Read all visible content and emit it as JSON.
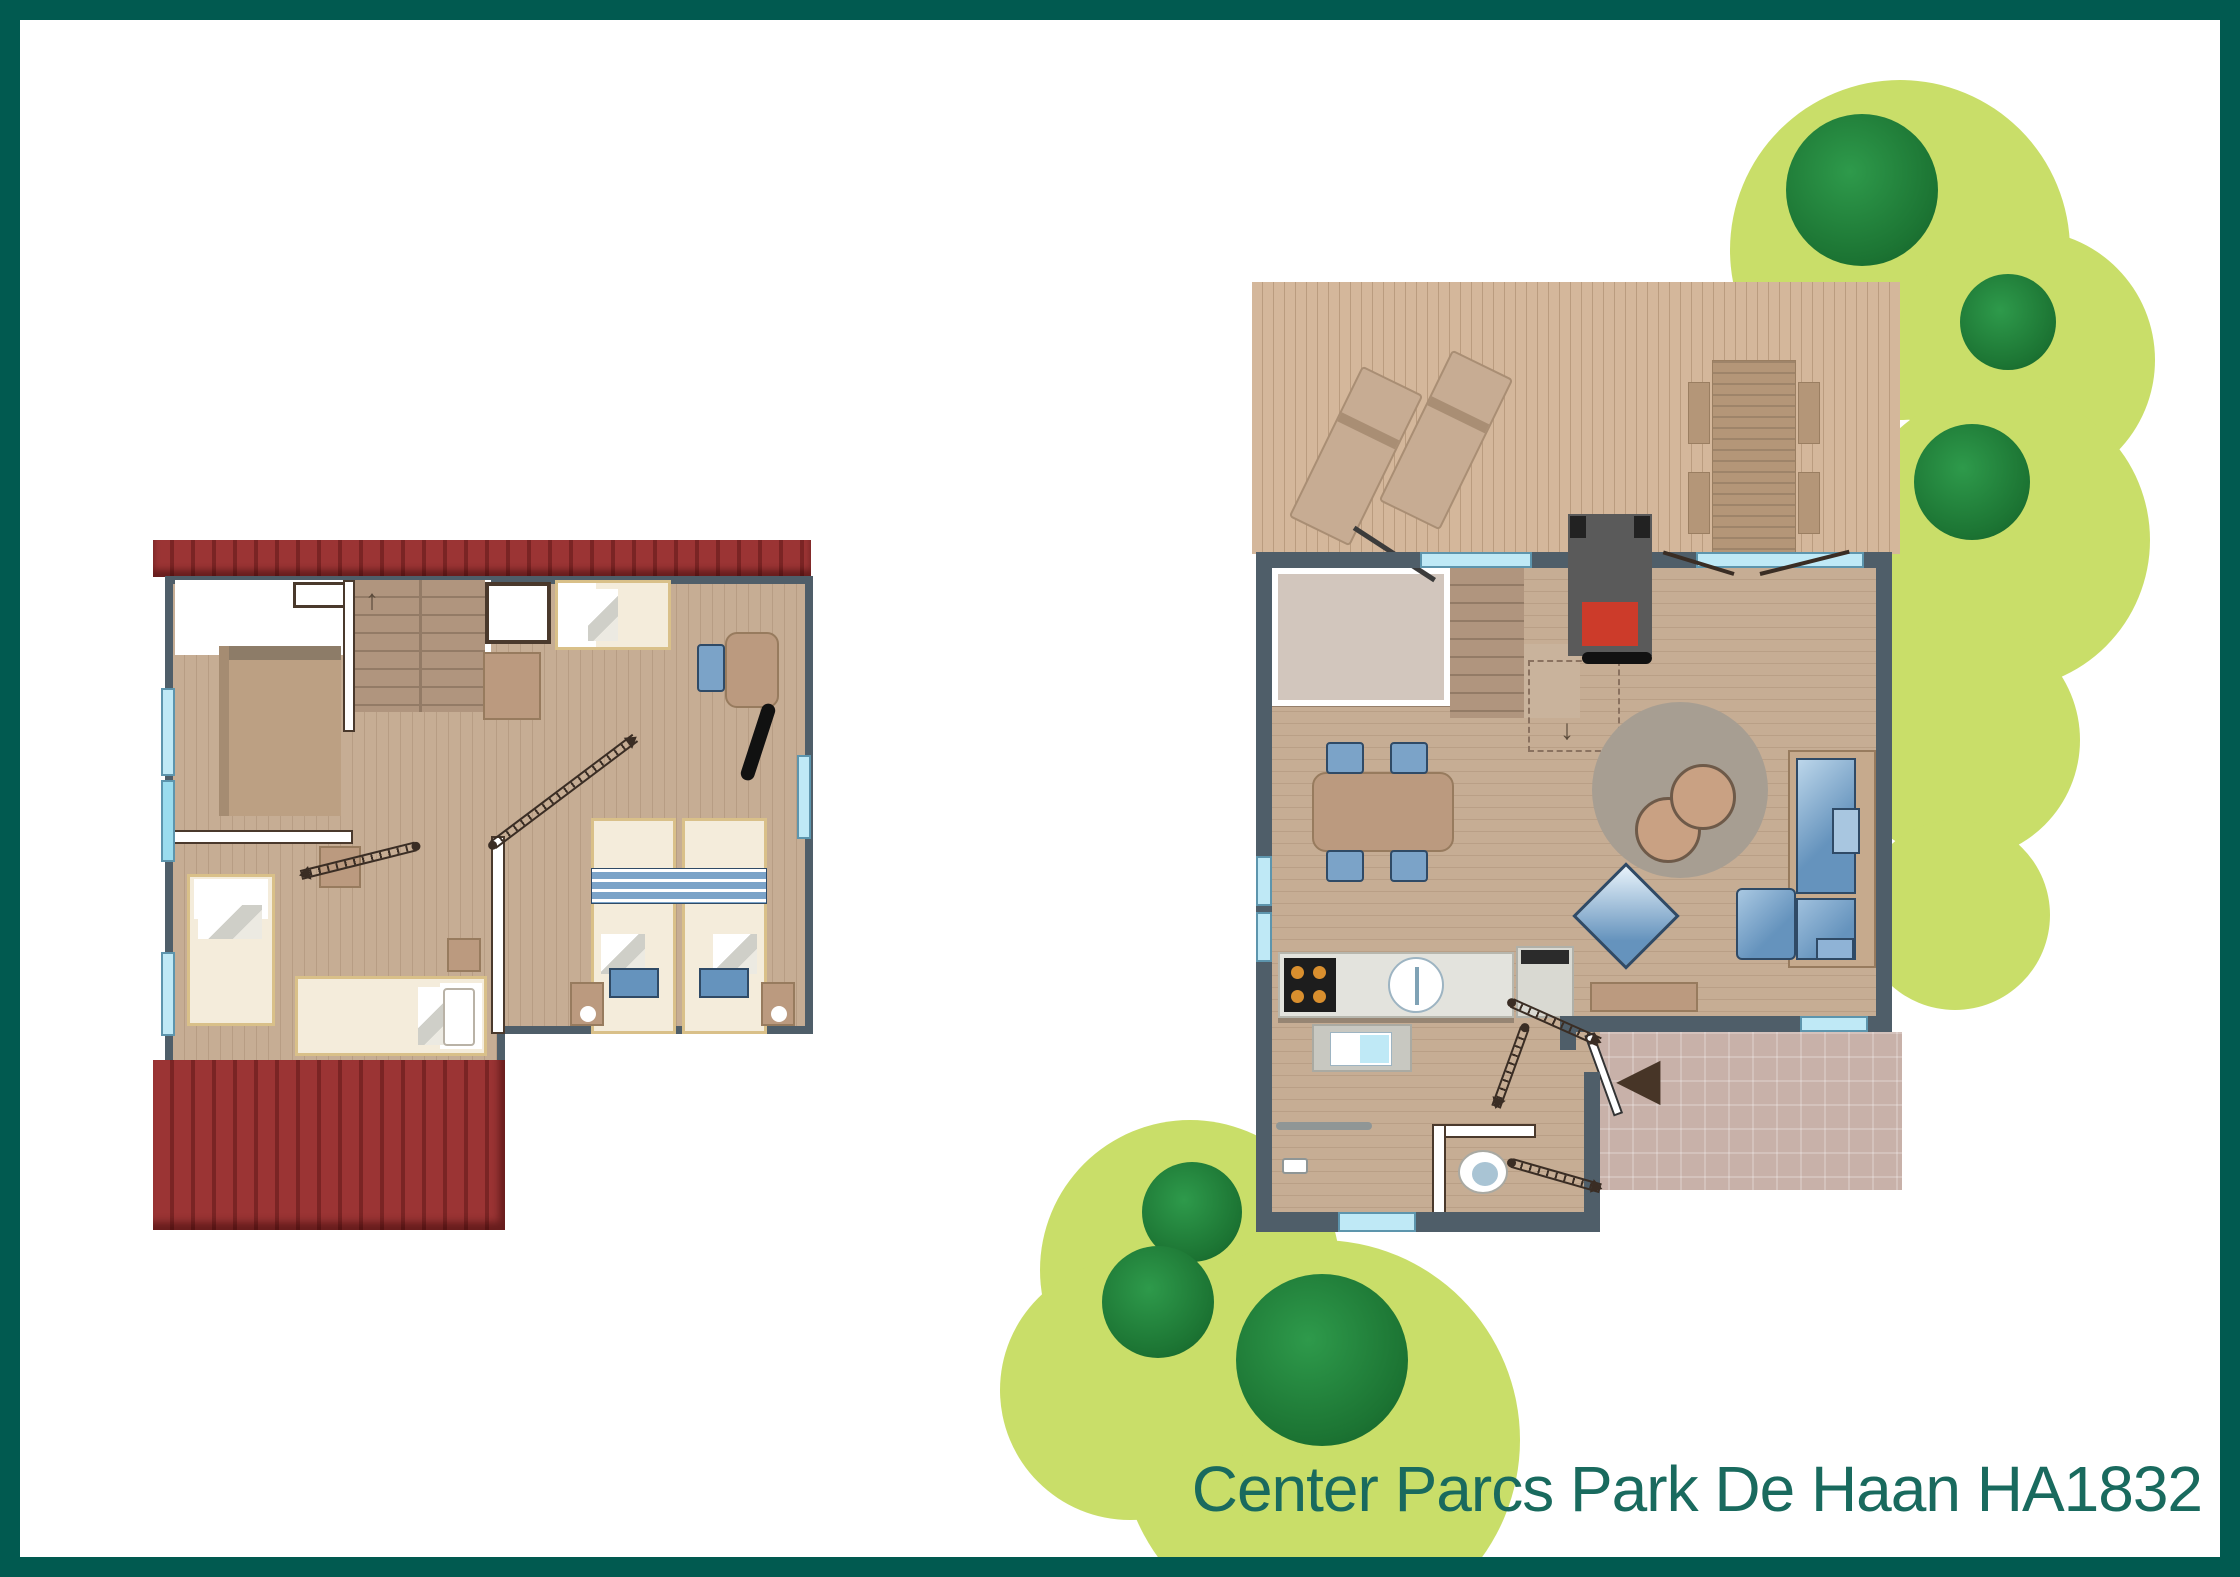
{
  "title": {
    "label": "Center Parcs Park De Haan HA1832"
  },
  "icons": {
    "entrance-arrow": "◀",
    "stairs-up-arrow": "↑",
    "stairs-down-arrow": "↓"
  },
  "colors": {
    "frame": "#015a50",
    "title": "#196a5e",
    "wall": "#4f5e69",
    "wwall-border": "#4a392c",
    "white-wall": "#ffffff",
    "floor": "#c6ad94",
    "room-pink": "#d2c6bd",
    "stairs": "#b0957e",
    "stair-line": "#937b66",
    "roof": "#9b3434",
    "roof-dark": "#7a2424",
    "deck": "#d4b79b",
    "green-light": "#c9de69",
    "tree-dark": "#1c7433",
    "window": "#bfe9f6",
    "window-frame": "#5d95ad",
    "bed": "#f4ecdb",
    "bed-frame": "#d9c089",
    "tan": "#bb9a7f",
    "tan-dark": "#977b5e",
    "blue": "#6593bd",
    "blue-light": "#a8c6e0",
    "blue-border": "#2f4a66",
    "chair-blue": "#7ba3c8",
    "rug": "#a79e92",
    "pouf": "#c9a183",
    "pouf-border": "#6e5a49",
    "patio": "#c8b1a9",
    "counter": "#e3e3dd",
    "stove": "#1d1d1d",
    "burner": "#d98f2e",
    "fire-gray": "#5a5a5a",
    "fire-red": "#cc3b2a",
    "swing": "#3a2d24"
  }
}
